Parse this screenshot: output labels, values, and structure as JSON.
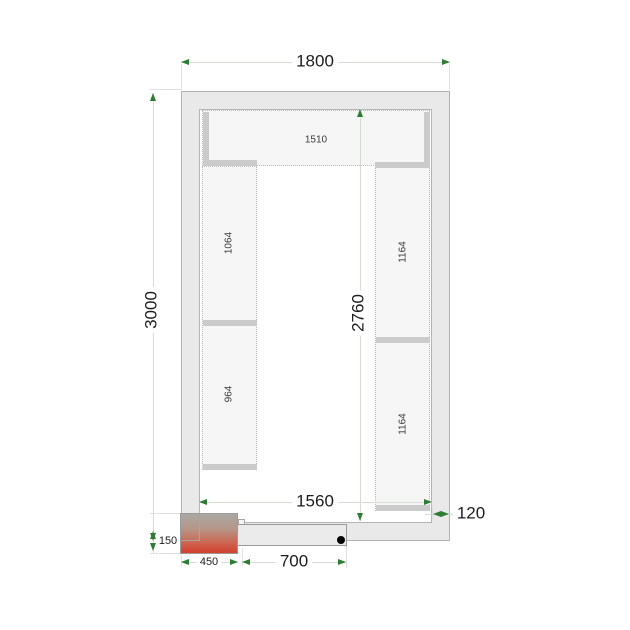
{
  "plan": {
    "type": "cold-room-floor-plan",
    "dimensions": {
      "outer_width": "1800",
      "outer_depth": "3000",
      "inner_depth": "2760",
      "inner_width": "1560",
      "wall_thickness": "120",
      "unit_protrusion": "150",
      "unit_width": "450",
      "door_width": "700"
    },
    "shelves": {
      "top": "1510",
      "left_upper": "1064",
      "left_lower": "964",
      "right_upper": "1164",
      "right_lower": "1164"
    },
    "colors": {
      "arrow_green": "#2e7d32",
      "wall_fill": "#e9e9e9",
      "shelf_fill": "#f6f6f6",
      "shelf_edge": "#cbcbcb",
      "unit_top": "#a9a9a3",
      "unit_bottom": "#d4402e",
      "hinge_dot": "#000000"
    }
  }
}
